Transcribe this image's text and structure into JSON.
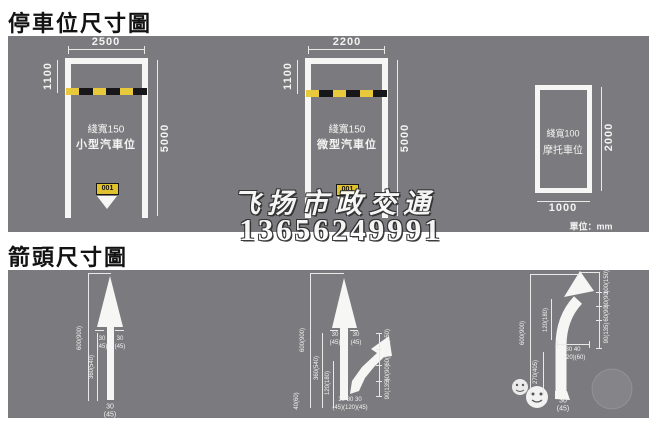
{
  "titles": {
    "parking": "停車位尺寸圖",
    "arrows": "箭頭尺寸圖"
  },
  "unit_note": "單位：mm",
  "watermark": {
    "line1": "飞扬市政交通",
    "line2": "13656249991"
  },
  "colors": {
    "panel_gray": "#7b7b7f",
    "marking_white": "#f6f6f4",
    "wheelstop_yellow": "#e7c93b",
    "wheelstop_black": "#17171a",
    "title_text": "#121212"
  },
  "parking": {
    "small_car": {
      "top": "2500",
      "entry": "1100",
      "side": "5000",
      "line": "綫寬150",
      "name": "小型汽車位",
      "num": "001"
    },
    "micro_car": {
      "top": "2200",
      "entry": "1100",
      "side": "5000",
      "line": "綫寬150",
      "name": "微型汽車位",
      "num": "001"
    },
    "motorcycle": {
      "side": "2000",
      "bottom": "1000",
      "line": "綫寬100",
      "name": "摩托車位"
    }
  },
  "arrows": {
    "straight": {
      "total": "600(900)",
      "shaft": "360(540)",
      "left": "30",
      "left_p": "(45)",
      "right": "30",
      "right_p": "(45)",
      "bottom": "30",
      "bottom_p": "(45)"
    },
    "combined": {
      "total": "600(900)",
      "shaft": "360(540)",
      "mid": "120(180)",
      "tail": "40(60)",
      "left": "30",
      "left_p": "(45)",
      "right": "30",
      "right_p": "(45)",
      "branch": [
        "100(150)",
        "60(90)",
        "60(90)",
        "90(135)"
      ],
      "bottom": "30  80  30",
      "bottom_p": "(45)(120)(45)"
    },
    "turn": {
      "total": "600(900)",
      "upper": "120(180)",
      "lower": "270(405)",
      "mid": "80  40",
      "mid_p": "(120)(60)",
      "branch": [
        "100(150)",
        "60(90)",
        "60(90)",
        "90(135)"
      ],
      "bottom": "30",
      "bottom_p": "(45)"
    }
  }
}
